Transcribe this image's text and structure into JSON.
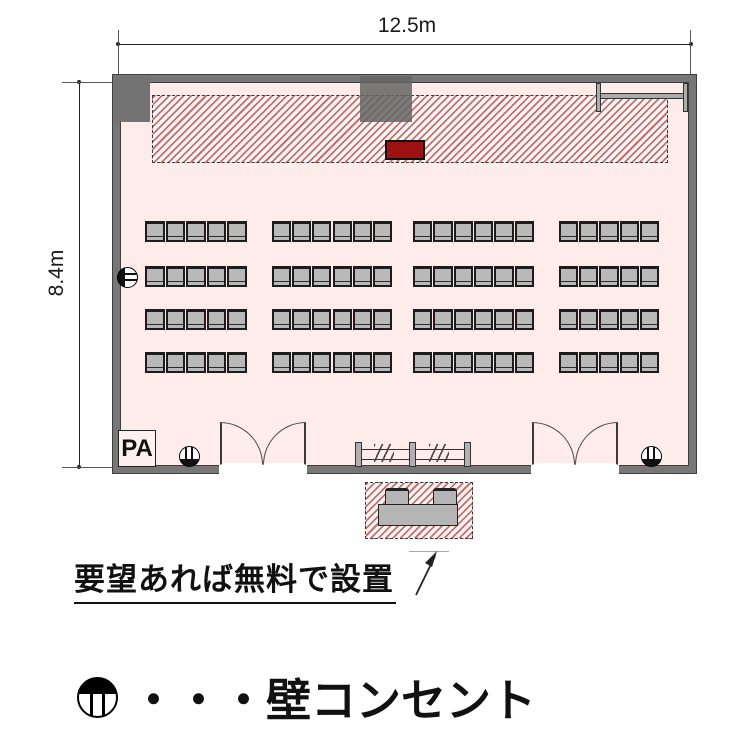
{
  "diagram": {
    "title": "meeting-room floor plan",
    "dimensions": {
      "width_label": "12.5m",
      "height_label": "8.4m"
    },
    "room": {
      "pa_label": "PA",
      "seating": {
        "rows": 4,
        "seats_per_row": 22,
        "total_seats": 88,
        "row_tops": [
          221,
          266,
          309,
          352
        ],
        "chair_height": 21,
        "groups": [
          {
            "x": 145,
            "count": 5,
            "width": 103
          },
          {
            "x": 272,
            "count": 6,
            "width": 121
          },
          {
            "x": 413,
            "count": 6,
            "width": 122
          },
          {
            "x": 559,
            "count": 5,
            "width": 101
          }
        ]
      },
      "outlets": [
        {
          "wall": "left",
          "x": 117,
          "y": 267,
          "rot": -90
        },
        {
          "wall": "bottom",
          "x": 179,
          "y": 446,
          "rot": 180
        },
        {
          "wall": "bottom",
          "x": 641,
          "y": 446,
          "rot": 180
        }
      ],
      "doors": [
        {
          "x": 220,
          "width": 86
        },
        {
          "x": 532,
          "width": 86
        }
      ]
    },
    "annotation": {
      "note": "要望あれば無料で設置"
    },
    "legend": {
      "symbol": "wall-outlet",
      "label": "・・・壁コンセント"
    },
    "colors": {
      "room_fill": "#fdecea",
      "wall": "#777777",
      "stage_hatch": "#c4706f",
      "lectern": "#9e1111",
      "chair": "#b9b9b9"
    }
  }
}
